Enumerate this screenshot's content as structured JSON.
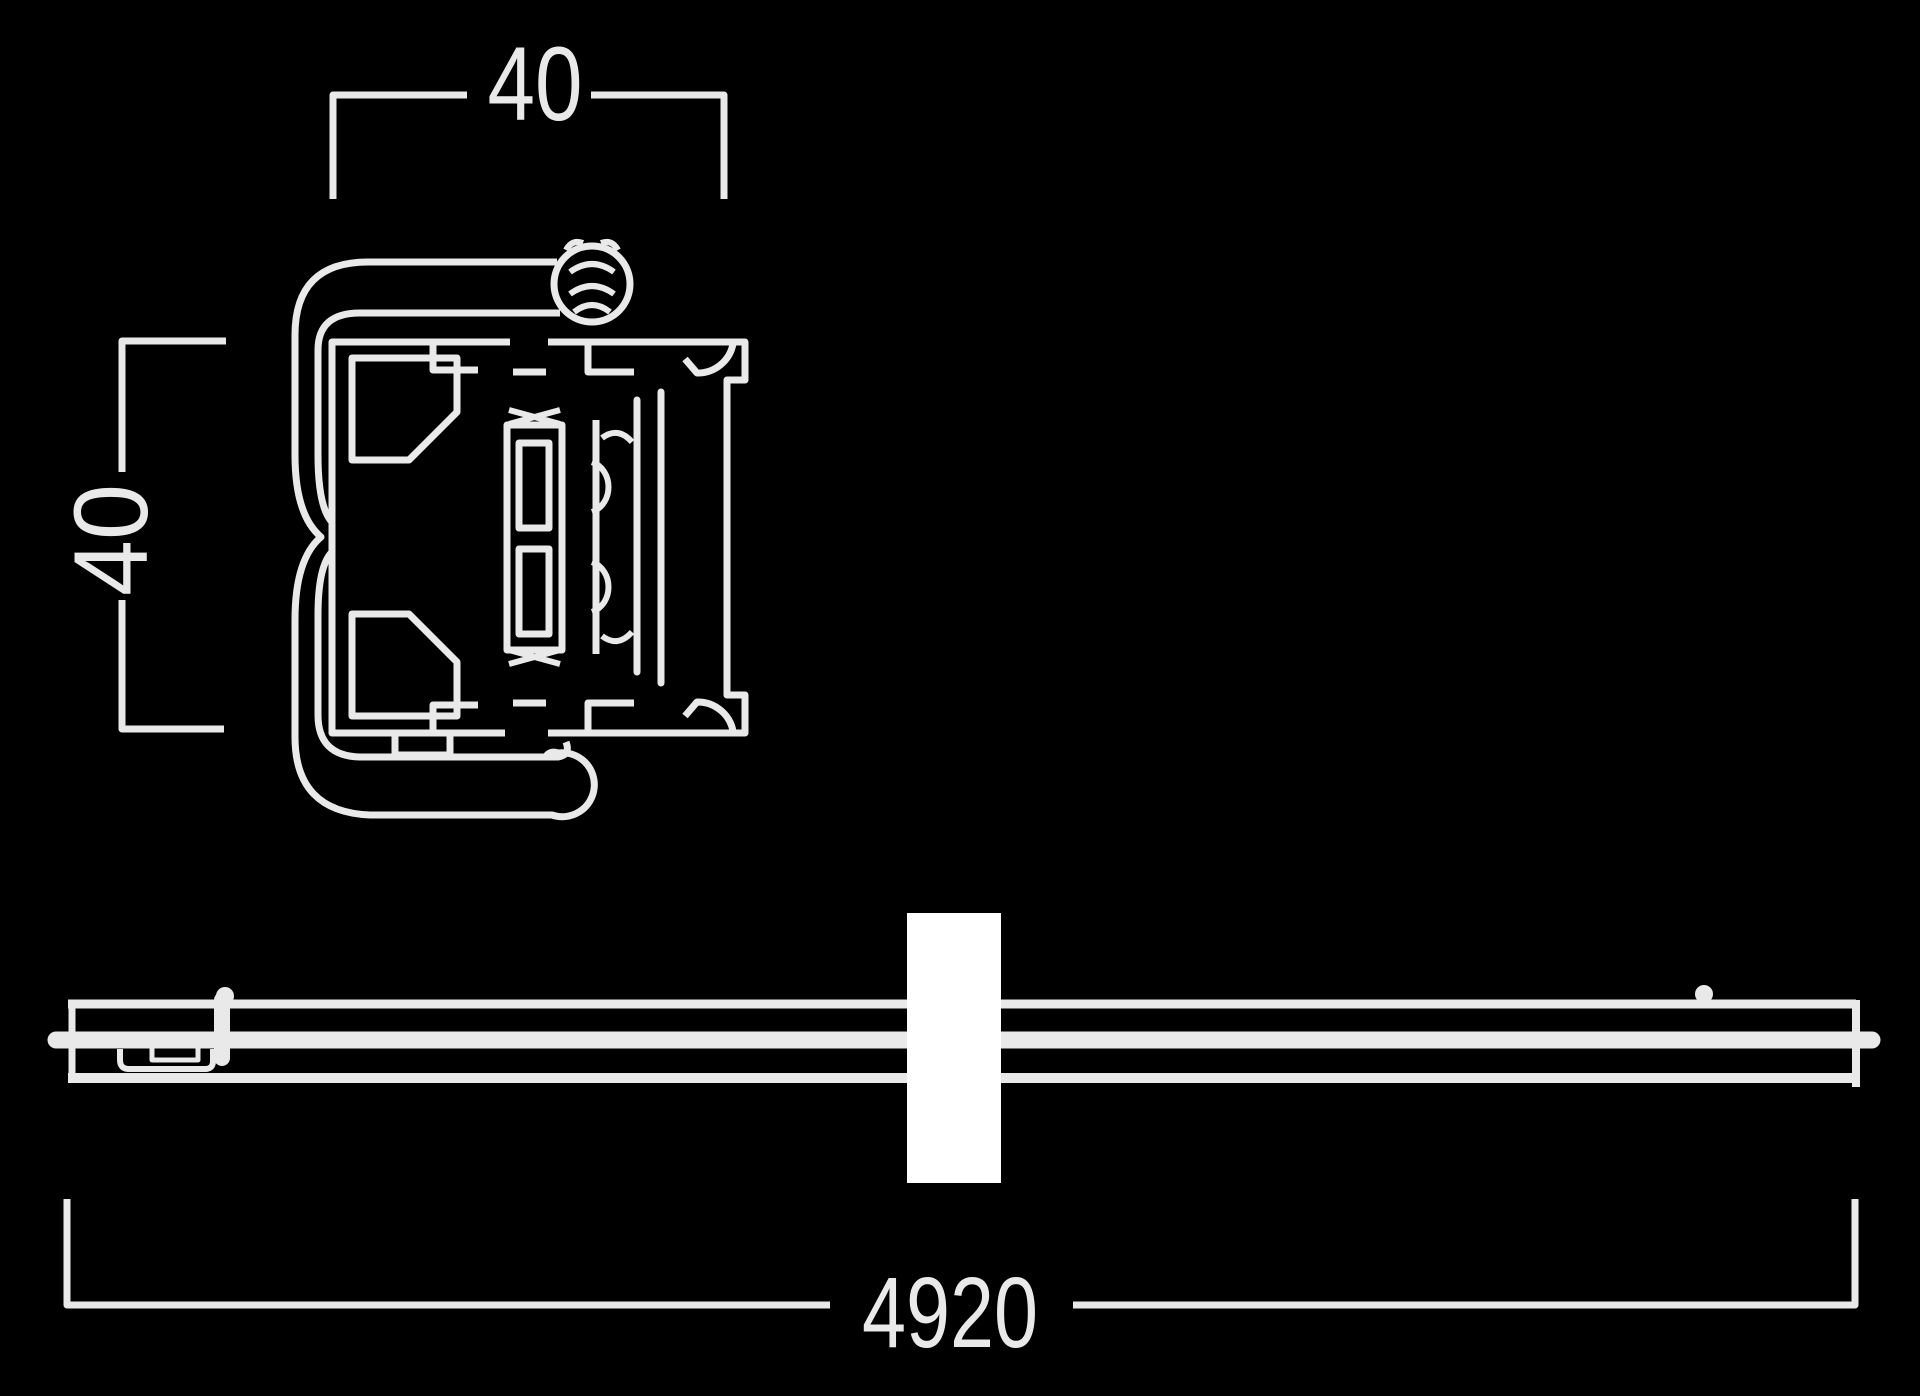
{
  "theme": {
    "background": "#000000",
    "line_color": "#e9e9e9",
    "break_marker_color": "#ffffff"
  },
  "drawing": {
    "type": "technical-line-drawing",
    "views": [
      {
        "name": "profile-cross-section",
        "labels": [
          "40",
          "40"
        ]
      },
      {
        "name": "rail-side-view",
        "labels": [
          "4920"
        ],
        "has_break_symbol": true
      }
    ]
  },
  "dimensions": {
    "profile_width": "40",
    "profile_height": "40",
    "rail_length": "4920"
  }
}
